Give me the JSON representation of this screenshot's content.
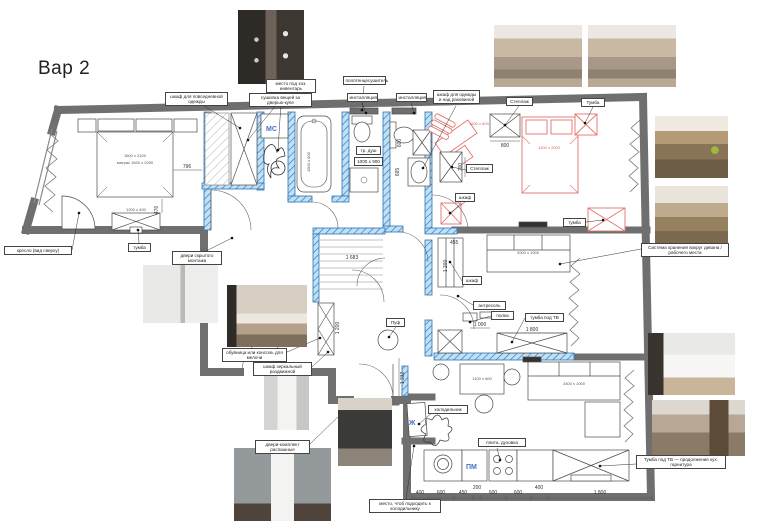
{
  "title": "Вар 2",
  "colors": {
    "wall": "#6f6f6f",
    "partition_stroke": "#2f74b5",
    "partition_fill": "#bfe0f5",
    "accent_red": "#e2736b",
    "accent_blue": "#4472c4"
  },
  "plan": {
    "marks": {
      "mc": "МС",
      "pm": "ПМ",
      "zh": "Ж"
    },
    "sizes": {
      "bed_main_1": "1600 х 2100",
      "bed_main_2": "матрас 1600 х 2000",
      "tv_main": "1200 х 400",
      "bath": "1800 х 800",
      "shower": "1000 х 900",
      "desk_red": "1600 х 600",
      "bed_red": "1400 х 2000",
      "sofa_living": "2000 х 1000",
      "table_kitchen": "1100 х 600",
      "sofa_kitchen": "2400 х 1000"
    },
    "dims": {
      "d796": "796",
      "d476": "476",
      "d1683": "1 683",
      "d1200_hall": "1 200",
      "d1332": "1 332",
      "d800": "800",
      "d700": "700",
      "d455": "455",
      "d1200_liv": "1 200",
      "d1000": "1 000",
      "d1800_liv": "1 800",
      "d600": "600",
      "d665": "665",
      "chain": [
        "400",
        "600",
        "450",
        "200",
        "600",
        "600",
        "400",
        "1 800"
      ]
    }
  },
  "annotations": {
    "everyday_wardrobe": "шкаф для повседневной одежды",
    "household": "место под хоз. инвентарь",
    "dryer": "сушилка вещей за дверью-купе",
    "towel_rail": "полотенцесушитель",
    "installation_1": "инсталляция",
    "installation_2": "инсталляция",
    "wardrobe_sink": "шкаф для одежды и над раковиной",
    "shelf_top": "Стеллаж",
    "cabinet_top": "Тумба",
    "shelf_inner": "Стеллаж",
    "wardrobe_red": "шкаф",
    "cabinet_red": "тумба",
    "storage_sofa": "Система хранения вокруг дивана / рабочего места",
    "wardrobe_living": "шкаф",
    "mezzanine": "антресоль",
    "shelf_small": "полка",
    "tv_cabinet": "тумба под ТВ",
    "tv_kitchen": "Тумба под ТВ — продолжение кух. гарнитура",
    "hidden_doors": "двери скрытого монтажа",
    "shoe_console": "обувница или консоль для мелочи",
    "mirror_wardrobe": "шкаф зеркальный раздвижной",
    "swing_doors": "двери-комплект распашные",
    "pouf": "Пуф",
    "fridge": "холодильник",
    "stove": "плита, духовка",
    "fridge_space": "место, чтоб подходить к холодильнику",
    "armchair": "кресло (вид сверху)",
    "shower_tray": "тр. душ",
    "cabinet_main": "тумба"
  }
}
